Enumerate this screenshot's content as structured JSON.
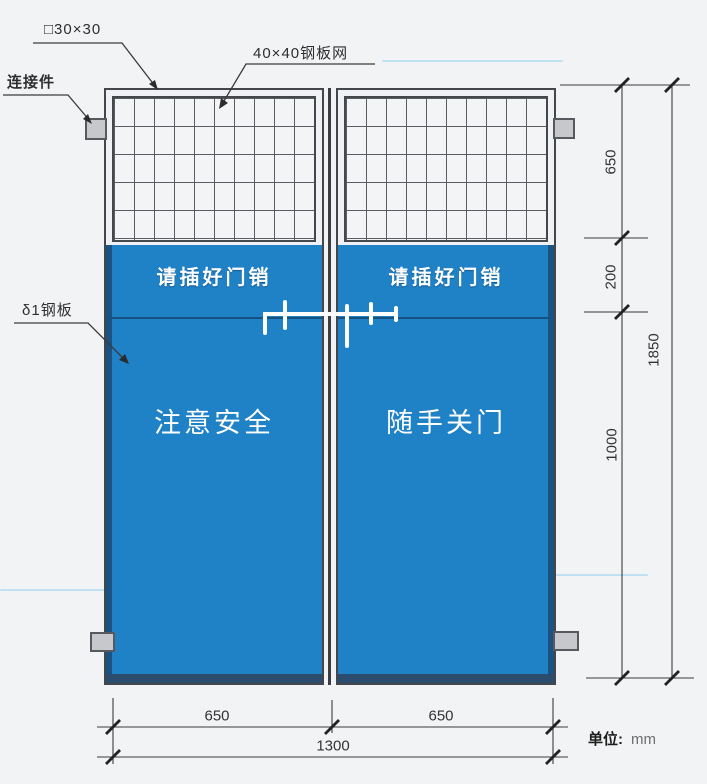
{
  "diagram": {
    "callouts": {
      "frame": "□30×30",
      "mesh": "40×40钢板网",
      "connector": "连接件",
      "plate": "δ1钢板"
    },
    "doors": {
      "left": {
        "band": "请插好门销",
        "main": "注意安全"
      },
      "right": {
        "band": "请插好门销",
        "main": "随手关门"
      }
    },
    "dims": {
      "v_top": "650",
      "v_mid": "200",
      "v_low": "1000",
      "v_total": "1850",
      "b_left": "650",
      "b_right": "650",
      "b_total": "1300"
    },
    "unit_label": "单位:",
    "unit_value": "mm",
    "colors": {
      "panel_blue": "#1f81c6",
      "panel_edge_dark": "#1b4a74",
      "frame_dark": "#43464b",
      "connector_gray": "#c6c8cc",
      "text_white": "#ffffff"
    }
  }
}
